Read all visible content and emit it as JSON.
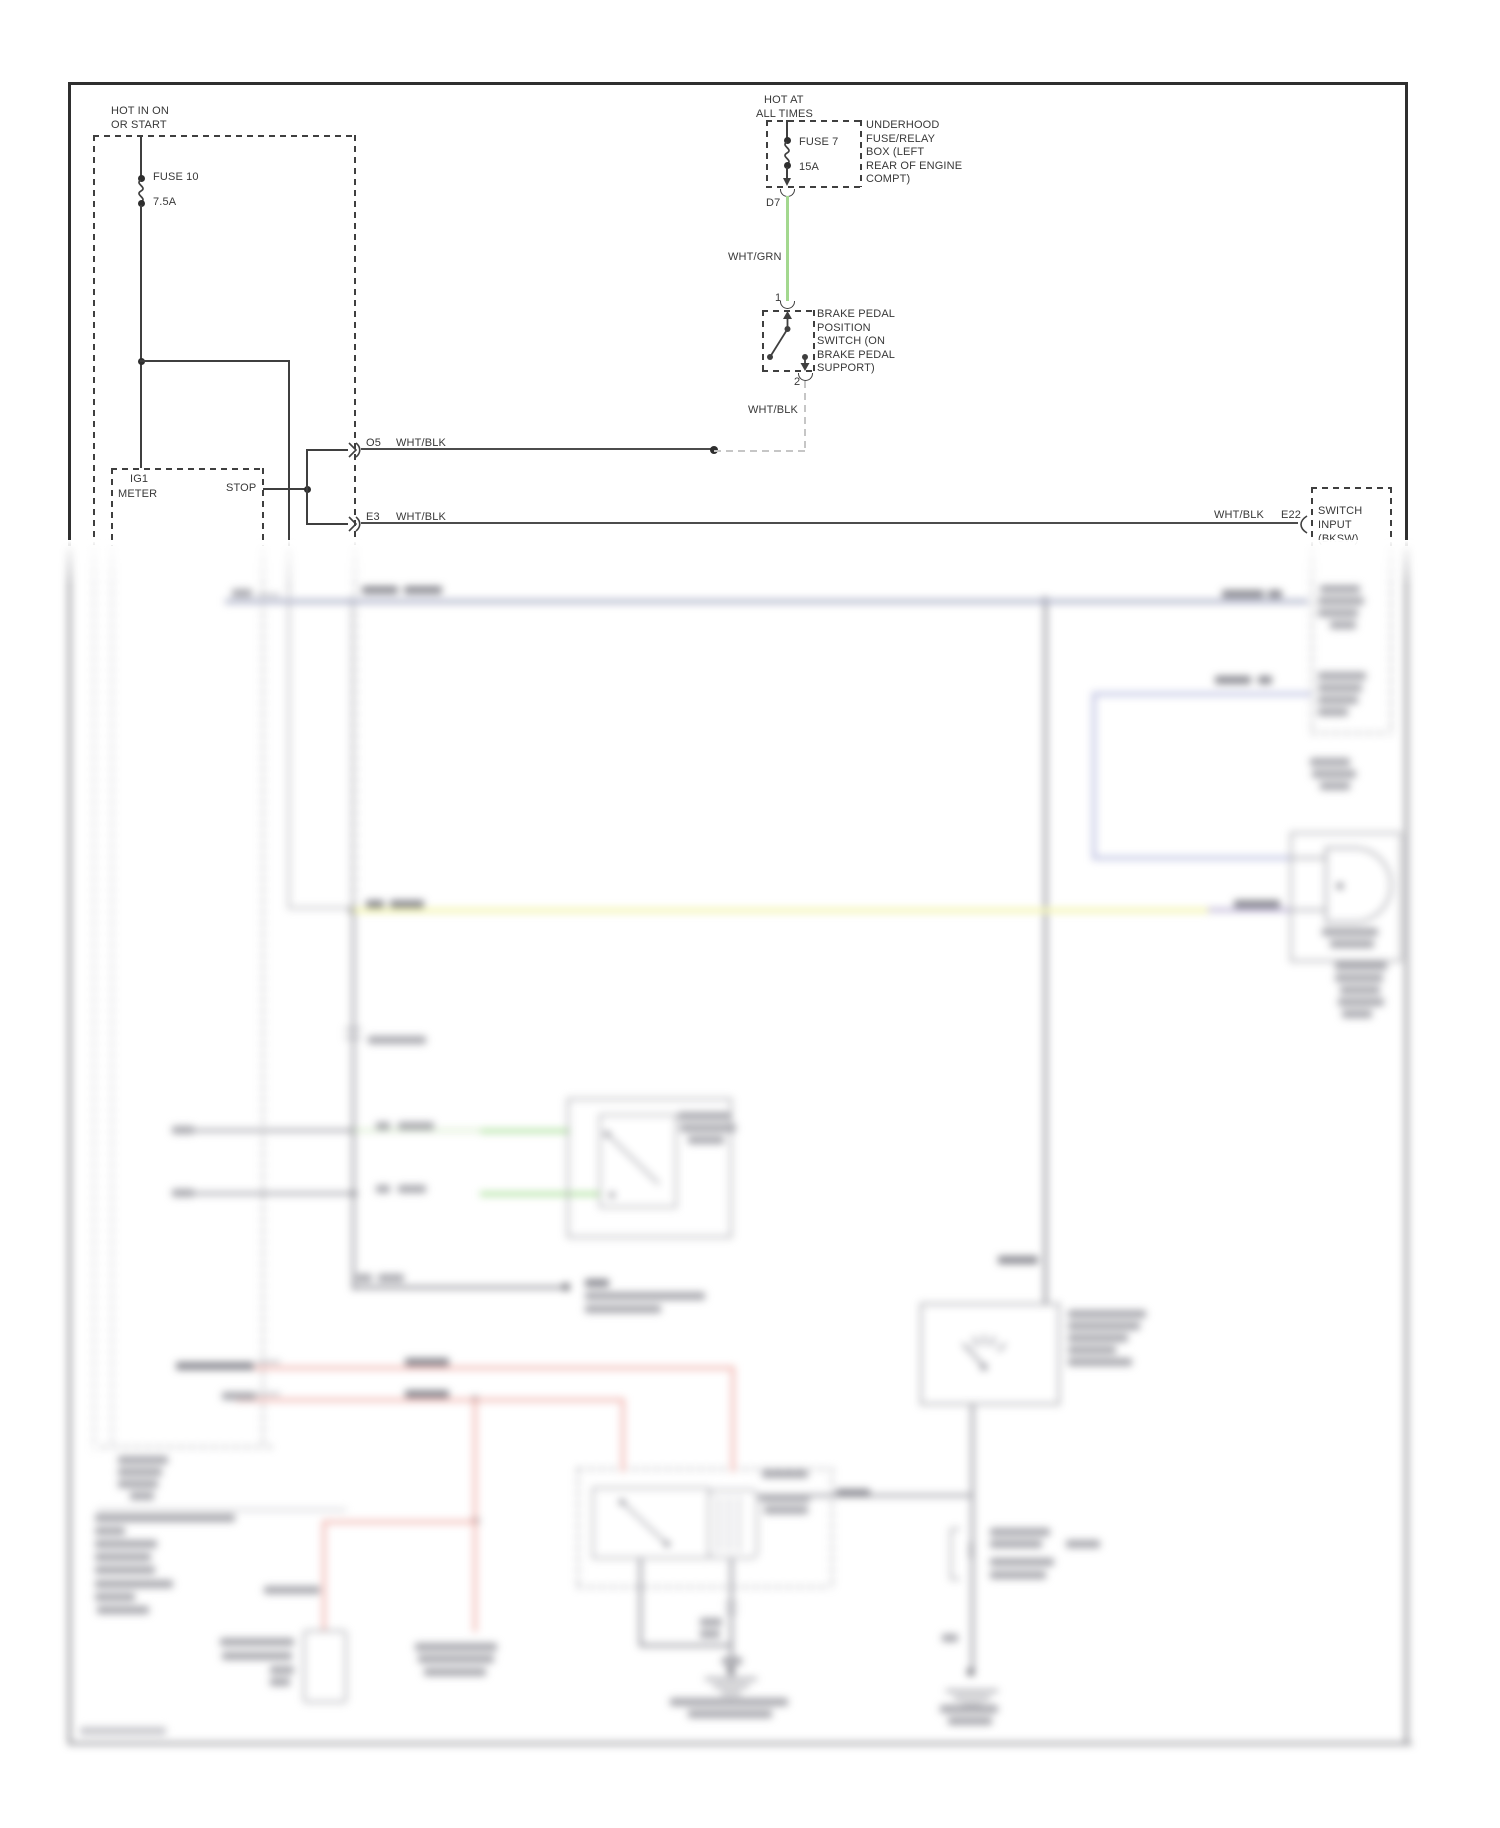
{
  "colors": {
    "line": "#3f3f3f",
    "wire_green": "#a3d88f",
    "wire_bluegray": "#a9aec6",
    "wire_periwinkle": "#b6bade",
    "wire_yellow": "#f3f5a3",
    "wire_violet": "#b3a9cf",
    "wire_pink": "#f2b3ad",
    "wire_bright_green": "#9cdb88"
  },
  "top_left": {
    "hot1": "HOT IN ON",
    "hot2": "OR START",
    "fuse": "FUSE 10",
    "amps": "7.5A",
    "meter1": "IG1",
    "meter2": "METER",
    "stop": "STOP"
  },
  "connectors": {
    "o5": "O5",
    "o5_wire": "WHT/BLK",
    "e3": "E3",
    "e3_wire": "WHT/BLK",
    "e22_wire": "WHT/BLK",
    "e22": "E22",
    "sw1": "SWITCH",
    "sw2": "INPUT",
    "sw3": "(BKSW)"
  },
  "top_center": {
    "hot1": "HOT AT",
    "hot2": "ALL TIMES",
    "fuse": "FUSE 7",
    "amps": "15A",
    "pin_d7": "D7",
    "wire_grn": "WHT/GRN",
    "pin1": "1",
    "pin2": "2",
    "wire_blk": "WHT/BLK",
    "underhood": [
      "UNDERHOOD",
      "FUSE/RELAY",
      "BOX (LEFT",
      "REAR OF ENGINE",
      "COMPT)"
    ],
    "brake": [
      "BRAKE PEDAL",
      "POSITION",
      "SWITCH (ON",
      "BRAKE PEDAL",
      "SUPPORT)"
    ]
  }
}
